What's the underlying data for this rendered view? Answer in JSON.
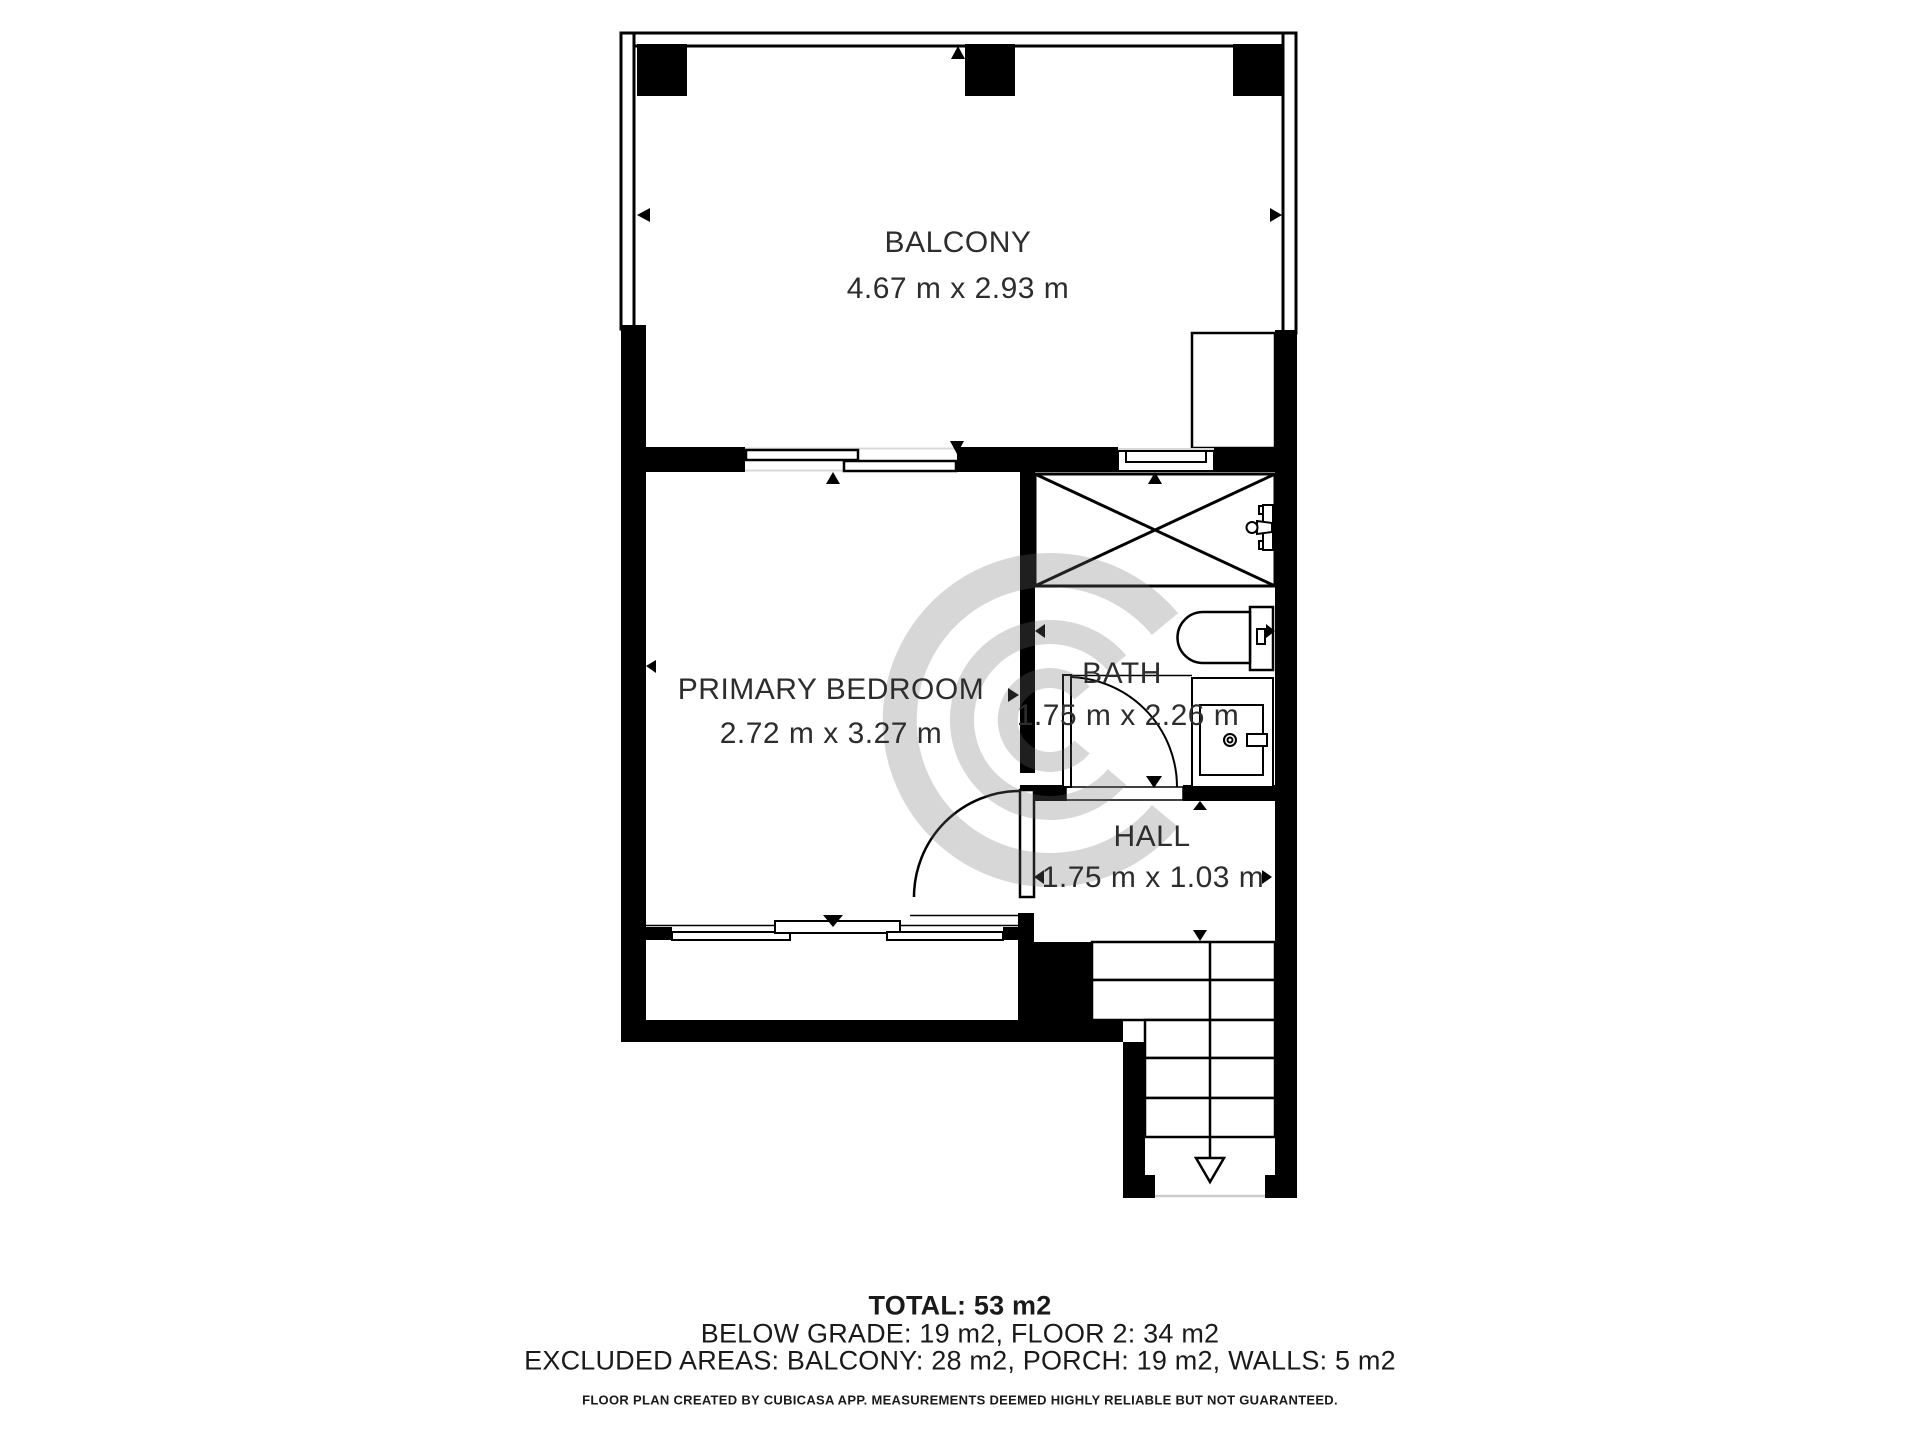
{
  "colors": {
    "wall": "#000000",
    "background": "#ffffff",
    "line": "#000000",
    "guide_gray": "#d8d8d8",
    "watermark_gray": "#6e6e6e"
  },
  "rooms": {
    "balcony": {
      "name": "BALCONY",
      "dimensions": "4.67 m x 2.93 m"
    },
    "primary_bedroom": {
      "name": "PRIMARY BEDROOM",
      "dimensions": "2.72 m x 3.27 m"
    },
    "bath": {
      "name": "BATH",
      "dimensions": "1.75 m x 2.26 m"
    },
    "hall": {
      "name": "HALL",
      "dimensions": "1.75 m x 1.03 m"
    }
  },
  "summary": {
    "total": "TOTAL: 53 m2",
    "floors": "BELOW GRADE: 19 m2, FLOOR 2: 34 m2",
    "excluded_areas": "EXCLUDED AREAS: BALCONY: 28 m2, PORCH: 19 m2, WALLS: 5 m2"
  },
  "footer": {
    "disclaimer": "FLOOR PLAN CREATED BY CUBICASA APP. MEASUREMENTS DEEMED HIGHLY RELIABLE BUT NOT GUARANTEED."
  }
}
